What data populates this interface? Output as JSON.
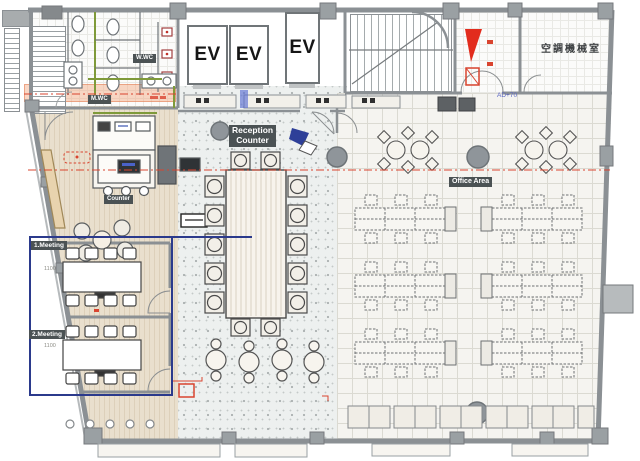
{
  "plan": {
    "elevators": [
      "EV",
      "EV",
      "EV"
    ],
    "rooms": {
      "ac_room": "空調機械室",
      "meeting_1": "1.Meeting",
      "meeting_2": "2.Meeting",
      "womens_wc": "W.WC",
      "mens_wc": "M.WC",
      "office_area": "Office Area"
    },
    "badges": {
      "reception_line1": "Reception",
      "reception_line2": "Counter",
      "counter": "Counter"
    },
    "annotations": {
      "level_note": "AD+70",
      "dim_1": "1100",
      "dim_2": "1100"
    },
    "colors": {
      "wall_gray": "#8b9094",
      "column_gray": "#8f959a",
      "wood_floor": "#e7dccb",
      "terrazzo_floor": "#edf0ef",
      "office_floor": "#f5f4f0",
      "corridor_salmon": "#f2a77f",
      "zone_blue": "#2b3a8c",
      "marker_red": "#d9442f",
      "accent_olive": "#7f9a3a",
      "badge_bg": "#4b5254",
      "bench_tan": "#e8d3ae",
      "level_note_blue": "#5a66c4"
    }
  }
}
